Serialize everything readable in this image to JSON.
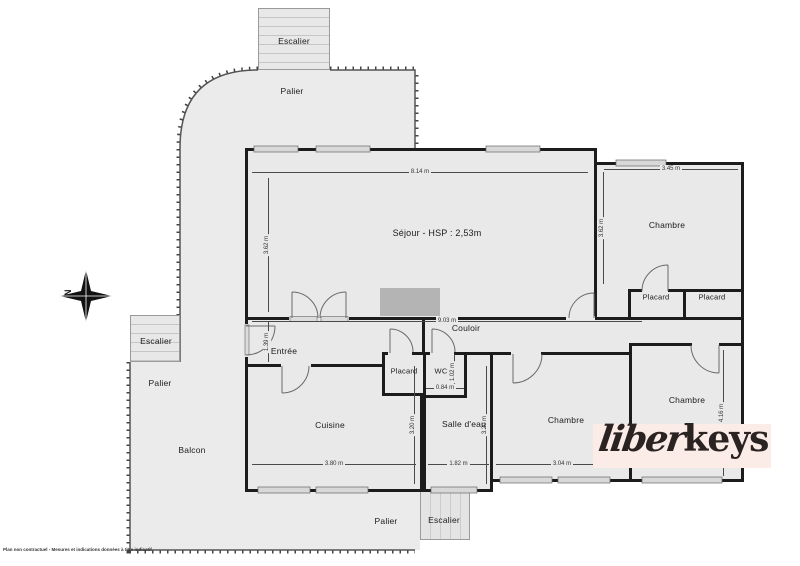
{
  "disclaimer": "Plan non contractuel - Mesures et indications données à titre indicatif",
  "compass": {
    "north": "N"
  },
  "logo": {
    "script": "liber",
    "bold": "keys"
  },
  "areas": {
    "escalier_top": "Escalier",
    "palier_top": "Palier",
    "escalier_left": "Escalier",
    "palier_left": "Palier",
    "balcon": "Balcon",
    "palier_bottom": "Palier",
    "escalier_bottom": "Escalier"
  },
  "rooms": {
    "sejour": "Séjour - HSP : 2,53m",
    "chambre_tr": "Chambre",
    "placard_tr1": "Placard",
    "placard_tr2": "Placard",
    "couloir": "Couloir",
    "entree": "Entrée",
    "cuisine": "Cuisine",
    "placard_mid": "Placard",
    "wc": "WC",
    "salle_eau": "Salle d'eau",
    "chambre_bm": "Chambre",
    "chambre_br": "Chambre"
  },
  "dims": {
    "sejour_w": "8.14 m",
    "sejour_h": "3.62 m",
    "chambre_tr_w": "3.45 m",
    "chambre_tr_h": "3.62 m",
    "couloir_w": "9.03 m",
    "entree_h": "1.39 m",
    "wc_h": "1.02 m",
    "wc_w": "0.84 m",
    "cuisine_w": "3.80 m",
    "cuisine_h": "3.20 m",
    "salle_eau_w": "1.82 m",
    "salle_eau_h": "3.20 m",
    "chambre_bm_w": "3.04 m",
    "chambre_br_h": "4.16 m"
  },
  "colors": {
    "room_fill": "#e9e9e9",
    "wall": "#1c1c1c",
    "terrace_fill": "#ebebeb",
    "logo_bg": "#fbece7",
    "logo_text": "#2a2322",
    "fixture": "#b4b4b4"
  }
}
